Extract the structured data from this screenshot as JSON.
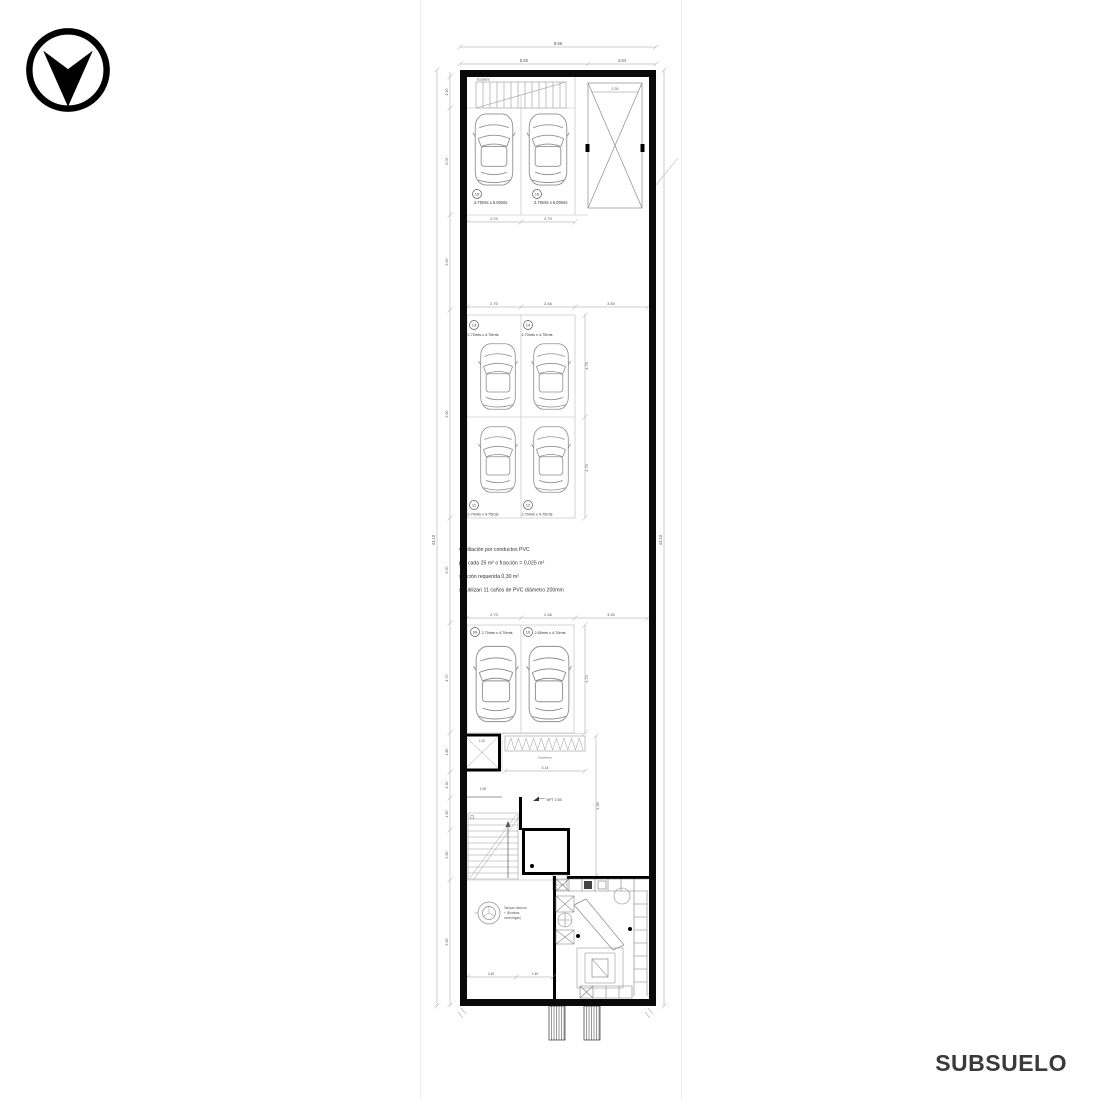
{
  "page": {
    "title": "SUBSUELO"
  },
  "logo": {
    "shape": "circle-down-arrow",
    "color": "#000000"
  },
  "plan": {
    "stalls": [
      {
        "num": "15",
        "size": "2.70mts x 6.00mts"
      },
      {
        "num": "16",
        "size": "2.70mts x 6.00mts"
      },
      {
        "num": "13",
        "size": "2.70mts x 4.75mts"
      },
      {
        "num": "14",
        "size": "2.70mts x 4.75mts"
      },
      {
        "num": "11",
        "size": "2.70mts x 4.75mts"
      },
      {
        "num": "12",
        "size": "2.70mts x 4.75mts"
      },
      {
        "num": "09",
        "size": "2.70mts x 4.70mts"
      },
      {
        "num": "10",
        "size": "2.65mts x 4.70mts"
      }
    ],
    "vent_note": [
      "ventilación por conductos PVC",
      "por cada 25 m² o fracción = 0,025 m²",
      "sección requerida 0,30 m²",
      "se utilizan 11 caños de PVC diámetro 200mm"
    ],
    "tank_label": [
      "Tanque cisterna",
      "+ (Bombas",
      "centrífugas)"
    ],
    "npt_label": "NPT 2.55",
    "stair_top_label": "Escalera",
    "bike_label": "bicicletero",
    "dims": {
      "top_overall": "8.66",
      "top_seg_a": "5.82",
      "top_seg_b": "2.84",
      "row_top_a": "2.70",
      "row_top_b": "2.70",
      "mid_a": "2.70",
      "mid_b": "2.46",
      "mid_c": "3.50",
      "low_a": "2.70",
      "low_b": "2.46",
      "low_c": "3.30",
      "depth_a": "4.75",
      "depth_b": "4.75",
      "depth_c": "4.70",
      "aisle_v": "4.30",
      "lift_w": "2.30",
      "elev_w": "1.20",
      "stair_lobby": "1.50",
      "tank_a": "2.40",
      "tank_b": "1.40",
      "bike": "3.14",
      "left_overall": "43.10",
      "right_overall": "43.10",
      "left_chain": [
        "1.20",
        "6.00",
        "3.00",
        "9.50",
        "5.00",
        "4.70",
        "1.80",
        "1.30",
        "1.50",
        "2.50",
        "5.90"
      ]
    }
  }
}
